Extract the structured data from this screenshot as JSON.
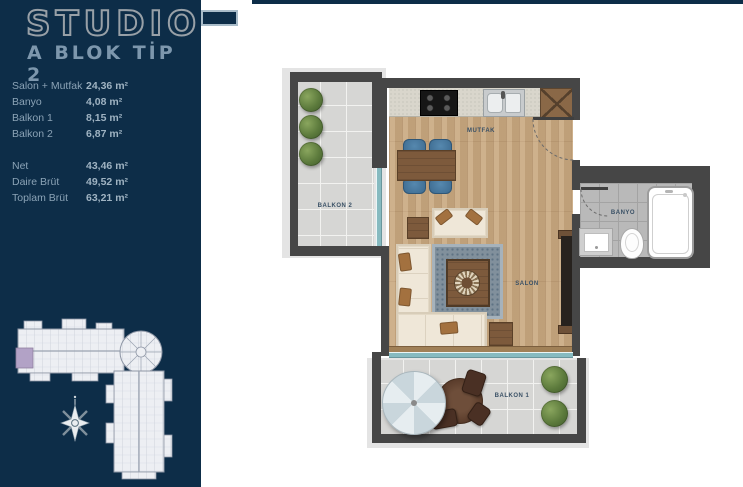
{
  "header": {
    "title": "STUDIO",
    "subtitle": "A BLOK TİP 2"
  },
  "areas": {
    "rooms": [
      {
        "label": "Salon + Mutfak",
        "value": "24,36 m²"
      },
      {
        "label": "Banyo",
        "value": "4,08 m²"
      },
      {
        "label": "Balkon 1",
        "value": "8,15 m²"
      },
      {
        "label": "Balkon 2",
        "value": "6,87 m²"
      }
    ],
    "totals": [
      {
        "label": "Net",
        "value": "43,46 m²"
      },
      {
        "label": "Daire Brüt",
        "value": "49,52 m²"
      },
      {
        "label": "Toplam Brüt",
        "value": "63,21 m²"
      }
    ]
  },
  "plan": {
    "labels": {
      "mutfak": "MUTFAK",
      "salon": "SALON",
      "banyo": "BANYO",
      "balkon1": "BALKON 1",
      "balkon2": "BALKON 2"
    }
  },
  "theme": {
    "navy": "#0d2d48",
    "title_grey": "#98a0a7",
    "subtitle_blue": "#7d97ad",
    "wall_grey": "#464646",
    "wood": "#c9a87f",
    "window_teal": "#86bac0",
    "highlight_unit": "#b2a2c6"
  }
}
